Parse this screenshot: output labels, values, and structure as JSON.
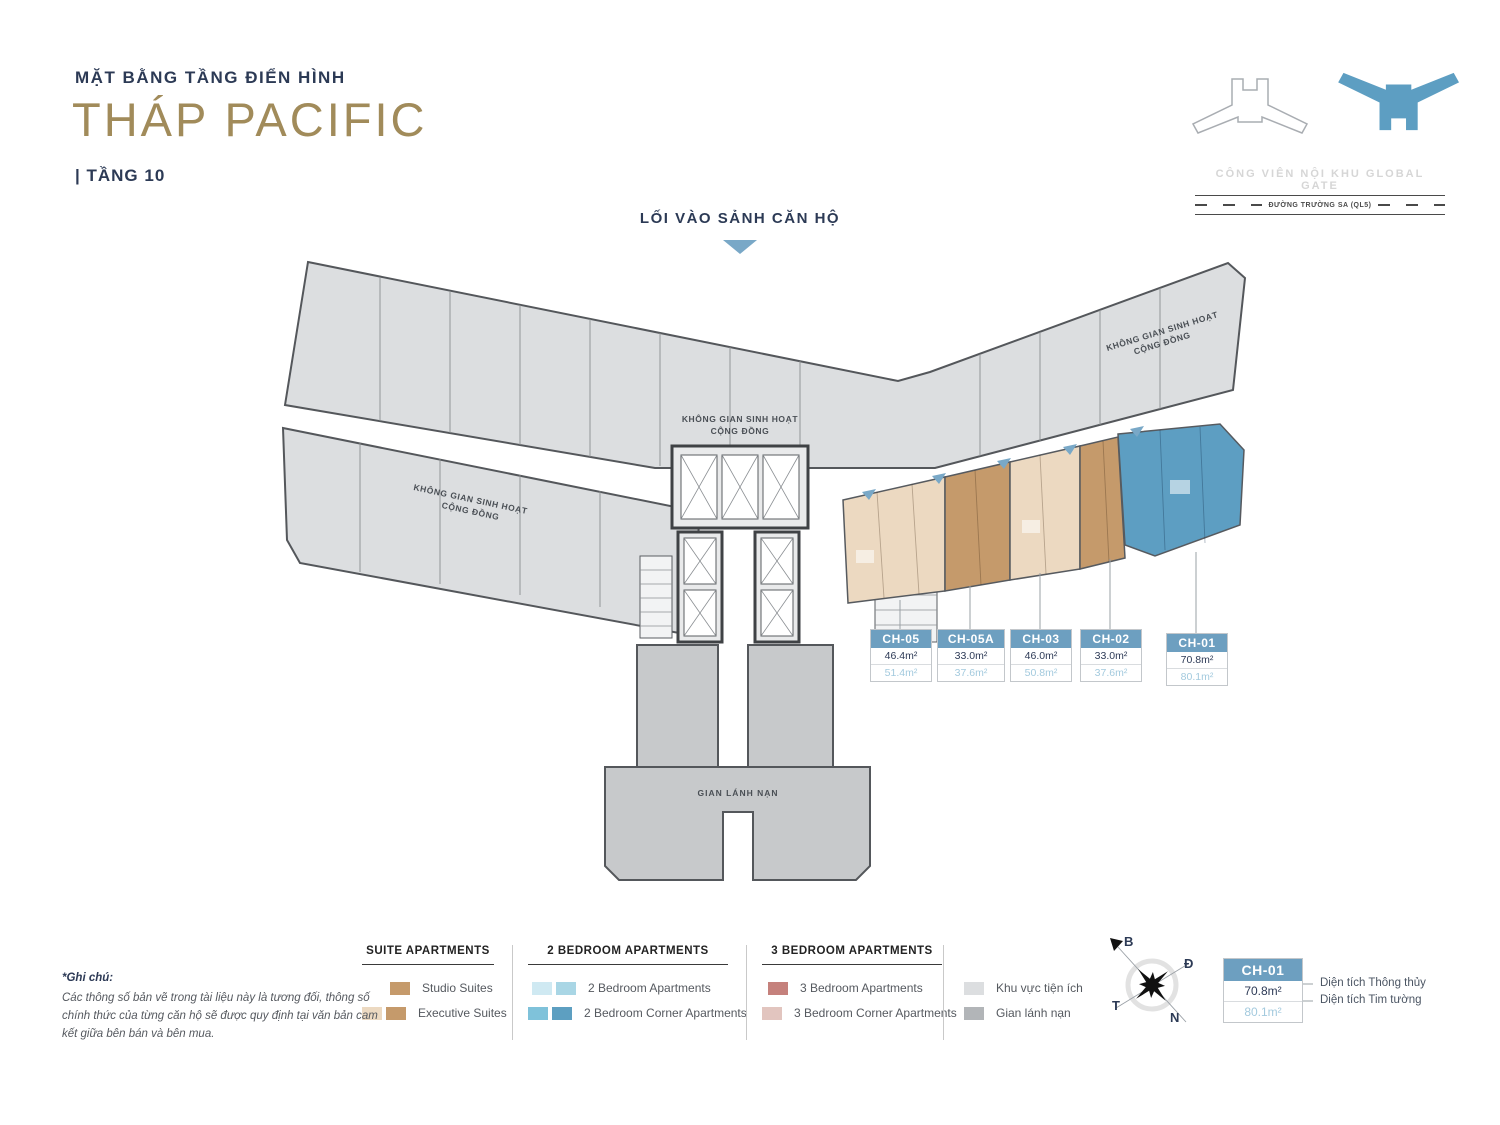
{
  "header": {
    "subtitle": "MẶT BẰNG TẦNG ĐIỂN HÌNH",
    "title": "THÁP PACIFIC",
    "floor": "| TẦNG 10"
  },
  "entrance_label": "LỐI VÀO SẢNH CĂN HỘ",
  "locator": {
    "park_label": "CÔNG VIÊN NỘI KHU GLOBAL GATE",
    "road_label": "ĐƯỜNG TRƯỜNG SA (QL5)"
  },
  "plan": {
    "community_line1": "KHÔNG GIAN SINH HOẠT",
    "community_line2": "CỘNG ĐỒNG",
    "refuge_label": "GIAN LÁNH NẠN"
  },
  "units": [
    {
      "id": "CH-05",
      "net": "46.4m²",
      "gross": "51.4m²"
    },
    {
      "id": "CH-05A",
      "net": "33.0m²",
      "gross": "37.6m²"
    },
    {
      "id": "CH-03",
      "net": "46.0m²",
      "gross": "50.8m²"
    },
    {
      "id": "CH-02",
      "net": "33.0m²",
      "gross": "37.6m²"
    },
    {
      "id": "CH-01",
      "net": "70.8m²",
      "gross": "80.1m²"
    }
  ],
  "legend": {
    "groups": [
      {
        "title": "SUITE APARTMENTS",
        "items": [
          {
            "label": "Studio Suites",
            "swatches": [
              "#c59a6b"
            ]
          },
          {
            "label": "Executive Suites",
            "swatches": [
              "#ecd9c1",
              "#c59a6b"
            ]
          }
        ]
      },
      {
        "title": "2 BEDROOM APARTMENTS",
        "items": [
          {
            "label": "2 Bedroom Apartments",
            "swatches": [
              "#cfe9f2",
              "#a9d6e5"
            ]
          },
          {
            "label": "2 Bedroom Corner Apartments",
            "swatches": [
              "#7fc2da",
              "#5d9fc1"
            ]
          }
        ]
      },
      {
        "title": "3 BEDROOM APARTMENTS",
        "items": [
          {
            "label": "3 Bedroom Apartments",
            "swatches": [
              "#c5817c"
            ]
          },
          {
            "label": "3 Bedroom Corner Apartments",
            "swatches": [
              "#e2c5bf"
            ]
          }
        ]
      }
    ],
    "extras": [
      {
        "label": "Khu vực tiện ích",
        "swatch": "#dcdee0"
      },
      {
        "label": "Gian lánh nạn",
        "swatch": "#b2b5b8"
      }
    ]
  },
  "compass": {
    "north": "B",
    "east": "Đ",
    "west": "T",
    "south": "N"
  },
  "sample": {
    "id": "CH-01",
    "net": "70.8m²",
    "net_label": "Diện tích Thông thủy",
    "gross": "80.1m²",
    "gross_label": "Diện tích Tim tường"
  },
  "note": {
    "title": "*Ghi chú:",
    "body": "Các thông số bản vẽ trong tài liệu này là tương đối, thông số chính thức của từng căn hộ sẽ được quy định tại văn bản cam kết giữa bên bán và bên mua."
  },
  "colors": {
    "navy": "#2c3a55",
    "gold": "#a18b5a",
    "tag_header_blue": "#6d9fc0",
    "gross_value_blue": "#a3cade",
    "entrance_arrow_blue": "#79a8c7",
    "unit_blue": "#5d9ec2",
    "unit_tan": "#c59a6b",
    "unit_cream": "#ecd9c1",
    "amenity_gray": "#dcdee0",
    "refuge_gray": "#c7c9cb"
  }
}
